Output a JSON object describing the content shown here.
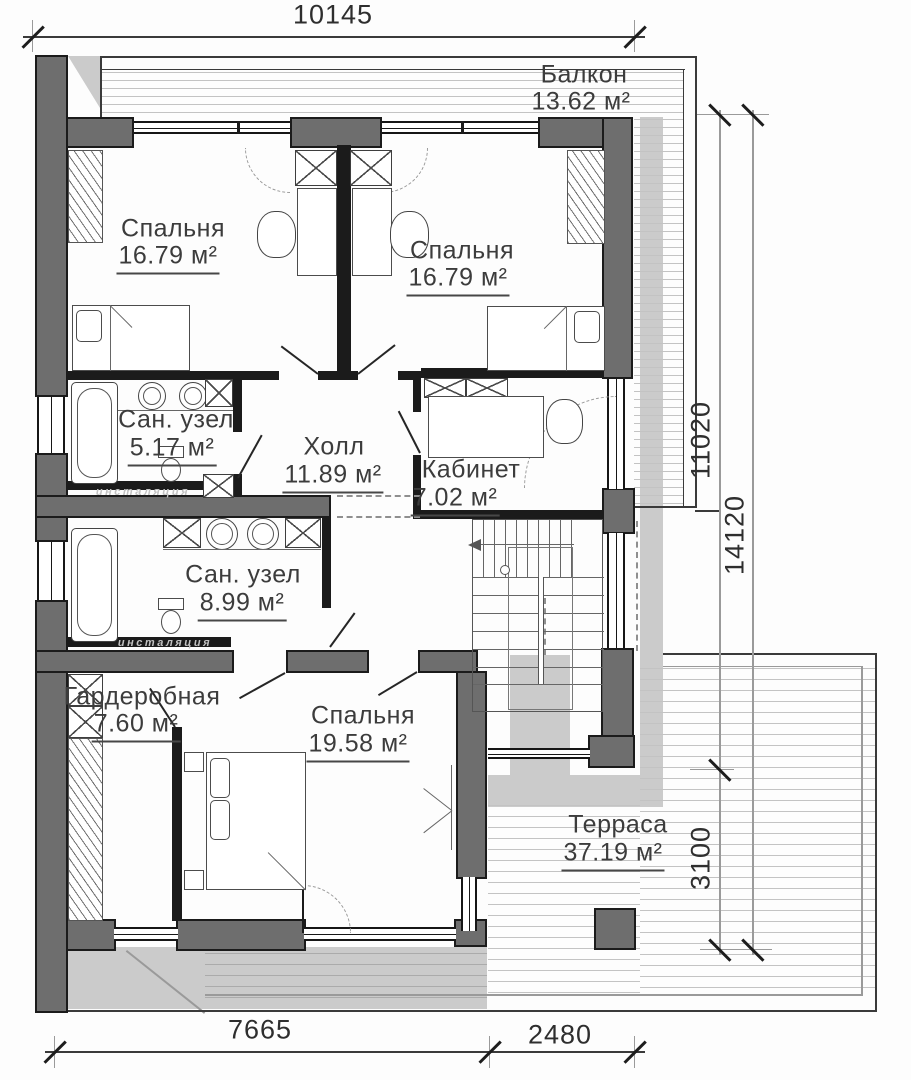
{
  "plan": {
    "rooms": [
      {
        "name": "Балкон",
        "area": "13.62 м²"
      },
      {
        "name": "Спальня",
        "area": "16.79 м²"
      },
      {
        "name": "Спальня",
        "area": "16.79 м²"
      },
      {
        "name": "Сан. узел",
        "area": "5.17 м²"
      },
      {
        "name": "Холл",
        "area": "11.89 м²"
      },
      {
        "name": "Кабинет",
        "area": "7.02 м²"
      },
      {
        "name": "Сан. узел",
        "area": "8.99 м²"
      },
      {
        "name": "Гардеробная",
        "area": "7.60 м²"
      },
      {
        "name": "Спальня",
        "area": "19.58 м²"
      },
      {
        "name": "Терраса",
        "area": "37.19 м²"
      }
    ],
    "dimensions": {
      "top": "10145",
      "bottom_left": "7665",
      "bottom_right": "2480",
      "right_upper": "11020",
      "right_full": "14120",
      "right_lower": "3100"
    },
    "annotations": {
      "installation": "инсталяция"
    },
    "colors": {
      "wall_fill": "#6e6e6e",
      "wall_dark": "#1b1b1b",
      "line": "#3a3a3a",
      "shadow": "#cbcbcb",
      "deck": "#c3c3c3",
      "text": "#3c3c3c",
      "dim": "#2e2e2e",
      "ann": "#c2c2c2"
    }
  }
}
